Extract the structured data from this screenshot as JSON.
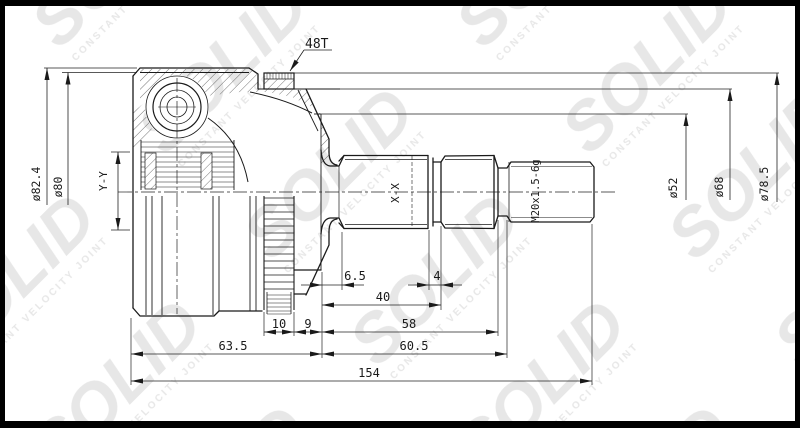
{
  "watermark": {
    "brand": "SOLID",
    "caption": "CONSTANT VELOCITY JOINT"
  },
  "colors": {
    "background": "#ffffff",
    "border": "#000000",
    "line": "#1a1a1a",
    "dim": "#222222",
    "watermark": "#e7e7e7"
  },
  "drawing": {
    "labels": {
      "teeth": "48T",
      "thread": "M20x1.5-6g",
      "section_hub": "Y-Y",
      "section_shaft": "X-X"
    },
    "diameters": {
      "housing_outer": "ø82.4",
      "housing_step": "ø80",
      "seal_seat": "ø52",
      "ring_seat": "ø68",
      "abs_ring": "ø78.5"
    },
    "lengths": {
      "seal_offset": "6.5",
      "groove_width": "4",
      "spline_to_groove": "40",
      "ring_width": "10",
      "seat_width": "9",
      "shaft_to_thread": "58",
      "housing_length": "63.5",
      "shaft_length": "60.5",
      "total": "154"
    }
  }
}
